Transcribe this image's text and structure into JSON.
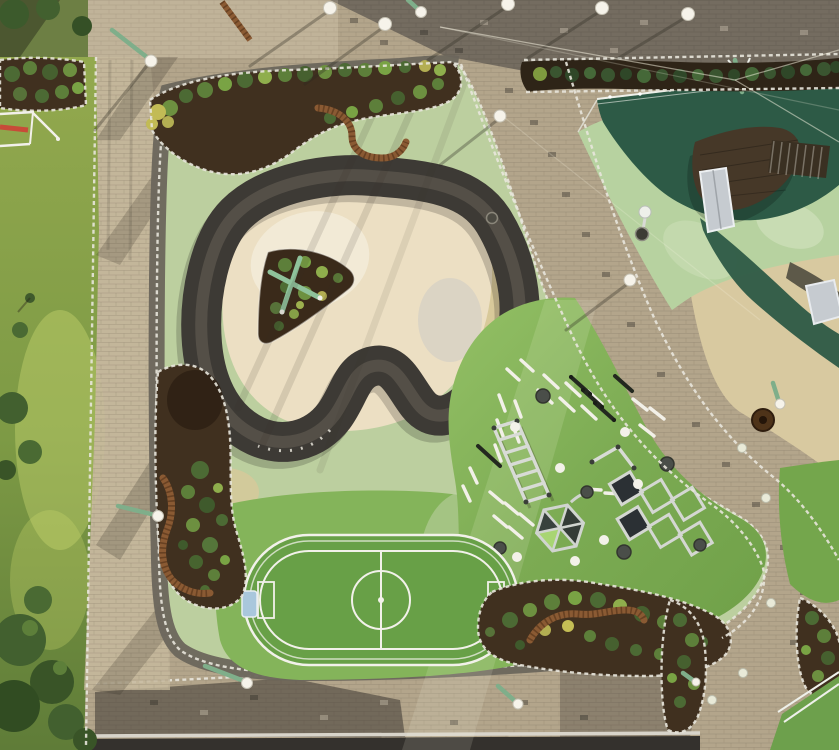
{
  "title": "Aerial drone view of a playground park at golden hour",
  "palette": {
    "paver_tan": "#b3a58b",
    "paver_light": "#c6b89c",
    "paver_dark": "#6f675c",
    "asphalt": "#34312d",
    "curb": "#d8d4ca",
    "meadow_top": "#93a94e",
    "meadow_bottom": "#5f7c38",
    "tree": "#42602f",
    "rubber_green": "#bccf9f",
    "rubber_tan": "#d9c89a",
    "apron_green": "#84b45a",
    "turf_green": "#7cab53",
    "turf_dark": "#6f9f4a",
    "infield_cream": "#ecdfc3",
    "track": "#3d3a35",
    "court_green": "#2d5a46",
    "court_light": "#b7d2a0",
    "soil": "#40301f",
    "hedge_soil": "#2e2417",
    "bench": "#8a5a33",
    "stone": "#e8e5dc",
    "slide": "#c6cbd0",
    "deck": "#463828",
    "goal_blue": "#a9c7dc",
    "equip_white": "#f2f0e8",
    "equip_silver": "#d8dbd6",
    "equip_dark": "#23281f",
    "pole_green": "#7fae8a",
    "lamp": "#f6f3ea",
    "beige": "#d8c9a0"
  },
  "scene": {
    "view": "top-down aerial photograph, long shadows falling to the south-west",
    "areas": {
      "pump_track": "dark asphalt pump-track loop with cream infield and triangular planted island",
      "soccer_field": "mini football pitch with white rink barrier, centre circle, centre line and two goals with pale blue roofs",
      "workout_zone": "bright green rubber calisthenics area with white dash floor markings, monkey-bar ladder, parallel bars, pull-up bar, hexagon climber, diamond lattice climber, rubber domes and white dots",
      "sports_court": "dark green multi-use court with white fence, wooden mound, embankment slide and stairs",
      "paths": "tan and grey paver walkways with white stone edging crossing diagonally",
      "planting_beds": "dark soil beds with shrubs, curved wooden benches and white stone borders",
      "meadow": "wild grass strip with trees on the left edge",
      "road": "dark asphalt strip along the bottom edge"
    },
    "counts": {
      "lamp_globes": 12,
      "leaning_green_poles": 7,
      "benches": 4,
      "planting_beds": 7,
      "goals": 2,
      "climbers": 2
    }
  }
}
